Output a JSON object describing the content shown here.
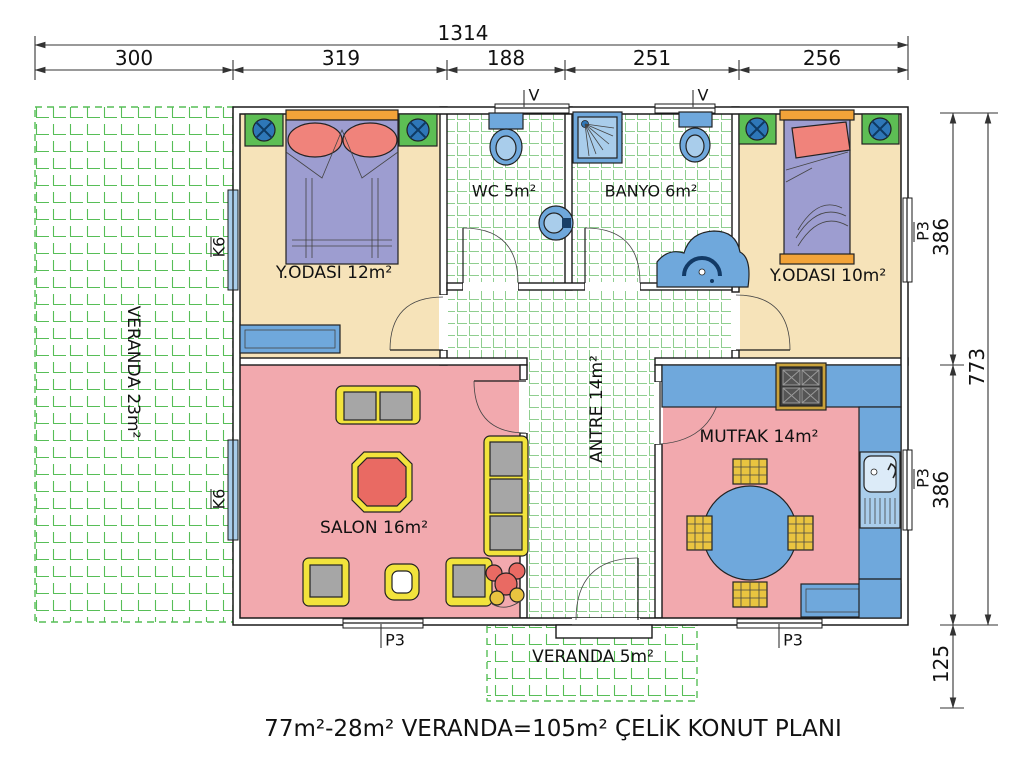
{
  "caption": {
    "text": "77m²-28m² VERANDA=105m² ÇELİK KONUT PLANI"
  },
  "dims": {
    "total": "1314",
    "segments": [
      "300",
      "319",
      "188",
      "251",
      "256"
    ],
    "right": {
      "seg_top": "386",
      "total": "773",
      "seg_bottom": "386",
      "veranda": "125"
    }
  },
  "rooms": {
    "veranda_left": "VERANDA 23m²",
    "bedroom1": "Y.ODASI 12m²",
    "wc": "WC 5m²",
    "bath": "BANYO 6m²",
    "bedroom2": "Y.ODASI 10m²",
    "hall": "ANTRE 14m²",
    "salon": "SALON 16m²",
    "kitchen": "MUTFAK 14m²",
    "veranda_bottom": "VERANDA 5m²"
  },
  "markers": {
    "vent": "V",
    "k6": "K6",
    "p3": "P3"
  },
  "colors": {
    "floor-bedroom": "#F6E3B9",
    "floor-living": "#F2A9AE",
    "tile-grid": "#8FCE8F",
    "veranda-grid": "#57BE57",
    "furniture-blue": "#6FA8DC",
    "furniture-blue-dark": "#2E77B8",
    "furniture-blue-light": "#A9CDEB",
    "bed-purple": "#9D9DD0",
    "pillow-red": "#F0837B",
    "headboard-orange": "#F2A339",
    "nightstand-green": "#5DBE54",
    "sofa-yellow": "#F2E33C",
    "cushion-gray": "#A6A6A6",
    "table-red": "#E96A63",
    "chair-yellow": "#E9C440",
    "wall-line": "#1A1A1A",
    "dim-line": "#333333"
  }
}
